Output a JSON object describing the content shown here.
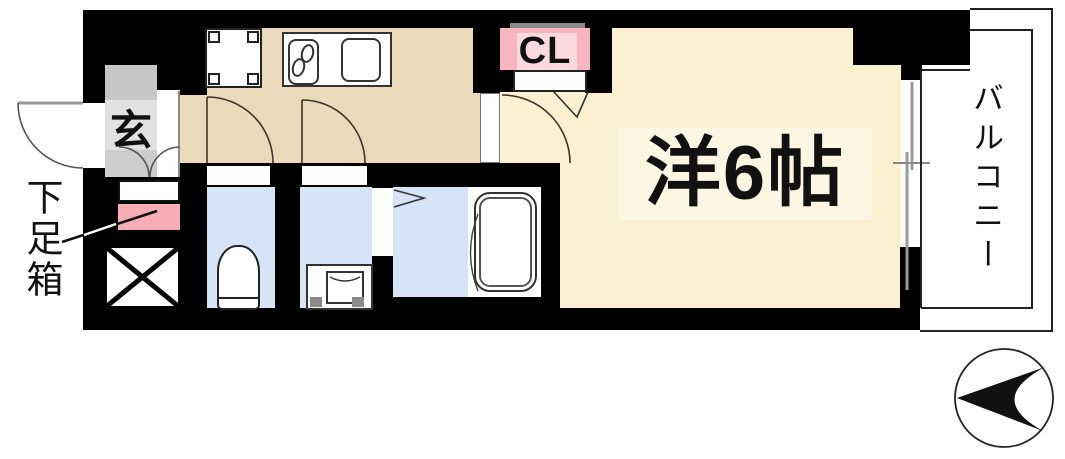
{
  "floorplan": {
    "labels": {
      "genkan": "玄",
      "shoe_box": "下足箱",
      "closet": "CL",
      "main_room": "洋6帖",
      "balcony": "バルコニー"
    },
    "colors": {
      "wall": "#000000",
      "kitchen_floor": "#EADAB9",
      "room_floor": "#FBF0D0",
      "room_label_bg": "#FCF6E3",
      "wet_area_floor": "#D5E5F7",
      "closet_pink": "#F6B5BF",
      "closet_pink_light": "#FBD9DE",
      "shoebox_pink": "#F7ADB4",
      "genkan_gray": "#D9D9D9",
      "hanger_bar_gray": "#8A8A8A"
    },
    "icons": [
      "entrance-door-swing-icon",
      "shoe-box-icon",
      "pipe-shaft-cross-icon",
      "refrigerator-space-icon",
      "kitchen-counter-icon",
      "stove-icon",
      "sink-icon",
      "toilet-icon",
      "washing-machine-pan-icon",
      "bathtub-icon",
      "folding-door-icon",
      "sliding-window-icon",
      "north-arrow-icon"
    ]
  }
}
